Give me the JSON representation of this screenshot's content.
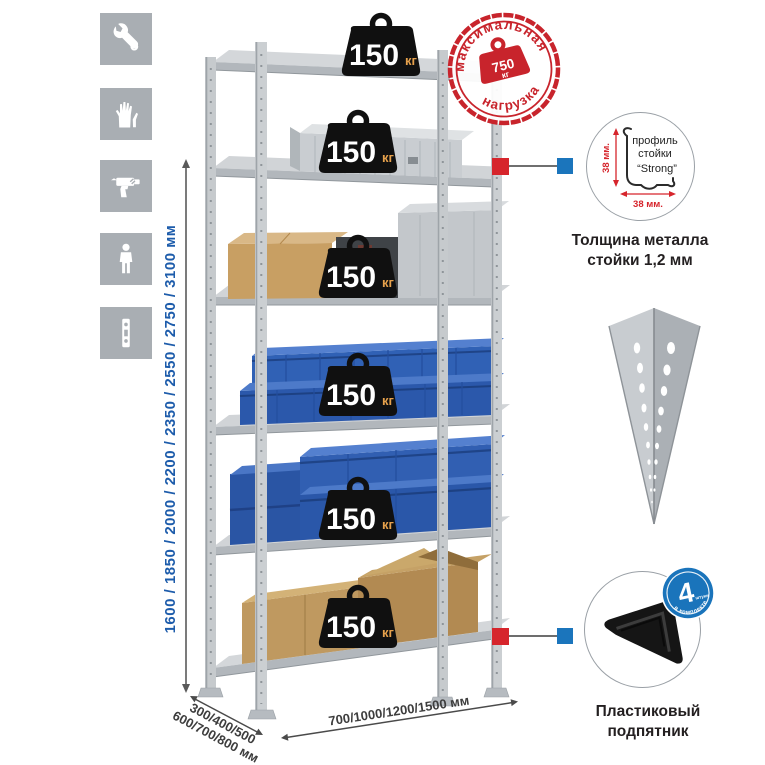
{
  "colors": {
    "accent_red": "#c8242c",
    "accent_blue": "#1b75bc",
    "dim_blue": "#1d5cab",
    "steel_gray": "#c6cacd",
    "bin_blue": "#2d5cb0",
    "cardboard": "#c49a63",
    "kg_orange": "#e6a14c",
    "icon_gray": "#a9aeb3"
  },
  "left_icons": {
    "items": [
      {
        "icon": "wrench"
      },
      {
        "icon": "gloves"
      },
      {
        "icon": "drill"
      },
      {
        "icon": "person"
      },
      {
        "icon": "rack-post"
      }
    ]
  },
  "dimensions": {
    "height": "1600 / 1850 / 2000 / 2200 / 2350 / 2550 / 2750 / 3100 мм",
    "depth_line1": "300/400/500",
    "depth_line2": "600/700/800 мм",
    "width": "700/1000/1200/1500 мм"
  },
  "rack": {
    "shelf_count": 6,
    "shelves": [
      {
        "load": "150",
        "unit": "кг"
      },
      {
        "load": "150",
        "unit": "кг"
      },
      {
        "load": "150",
        "unit": "кг"
      },
      {
        "load": "150",
        "unit": "кг"
      },
      {
        "load": "150",
        "unit": "кг"
      },
      {
        "load": "150",
        "unit": "кг"
      }
    ]
  },
  "stamp": {
    "arc_top": "максимальная",
    "arc_bottom": "нагрузка",
    "value": "750",
    "unit": "кг"
  },
  "profile_detail": {
    "line1": "профиль",
    "line2": "стойки",
    "line3": "“Strong”",
    "dim_v": "38 мм.",
    "dim_h": "38 мм.",
    "caption1": "Толщина металла",
    "caption2": "стойки 1,2 мм"
  },
  "foot_detail": {
    "badge_number": "4",
    "badge_small": "штуки",
    "badge_arc": "в комплекте",
    "caption1": "Пластиковый",
    "caption2": "подпятник"
  }
}
